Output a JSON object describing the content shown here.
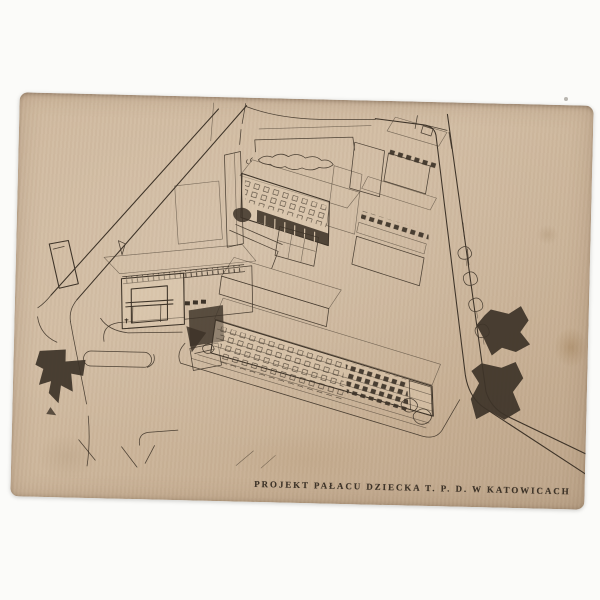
{
  "scene": {
    "background_color": "#fbfbf9",
    "description": "Photograph of an aged beige postcard lying slightly rotated on a white background"
  },
  "postcard": {
    "rotation_deg": 1.35,
    "colors": {
      "paper": "#ccb59a",
      "paper-light": "#d9c5ab",
      "paper-dark": "#b89f84",
      "ink": "#3d3328",
      "stain": "#8f6a3d"
    },
    "caption": {
      "text": "PROJEKT PAŁACU DZIECKA T. P. D. W KATOWICACH"
    },
    "drawing": {
      "subject": "aerial perspective ink sketch of a modernist building complex (Children's Palace) with entrance pavilion, long four-storey front wing, inner courtyards with sports court, hatched roofs, surrounding streets and dark trees"
    }
  }
}
